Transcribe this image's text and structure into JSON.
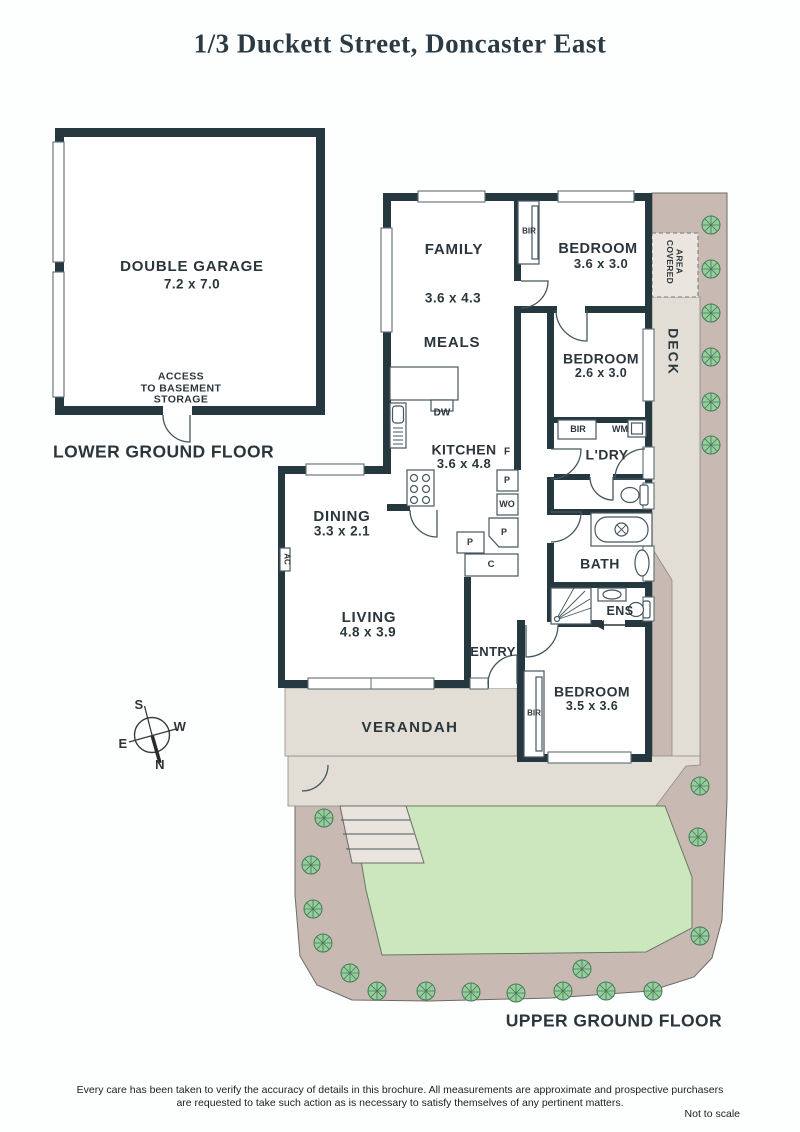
{
  "title": "1/3 Duckett Street, Doncaster East",
  "floors": {
    "lower_label": "LOWER GROUND FLOOR",
    "upper_label": "UPPER GROUND FLOOR"
  },
  "rooms": {
    "garage": {
      "name": "DOUBLE GARAGE",
      "dims": "7.2 x 7.0"
    },
    "family": {
      "name": "FAMILY",
      "dims": "3.6 x 4.3"
    },
    "meals": {
      "name": "MEALS"
    },
    "kitchen": {
      "name": "KITCHEN",
      "dims": "3.6 x 4.8"
    },
    "dining": {
      "name": "DINING",
      "dims": "3.3 x 2.1"
    },
    "living": {
      "name": "LIVING",
      "dims": "4.8 x 3.9"
    },
    "entry": {
      "name": "ENTRY"
    },
    "verandah": {
      "name": "VERANDAH"
    },
    "deck": {
      "name": "DECK"
    },
    "covered_area": {
      "line1": "COVERED",
      "line2": "AREA"
    },
    "bedroom1": {
      "name": "BEDROOM",
      "dims": "3.6 x 3.0"
    },
    "bedroom2": {
      "name": "BEDROOM",
      "dims": "2.6 x 3.0"
    },
    "bedroom3": {
      "name": "BEDROOM",
      "dims": "3.5 x 3.6"
    },
    "laundry": {
      "name": "L'DRY"
    },
    "bath": {
      "name": "BATH"
    },
    "ens": {
      "name": "ENS"
    }
  },
  "fixtures": {
    "bir": "BIR",
    "wm": "WM",
    "dw": "DW",
    "fridge": "F",
    "pantry": "P",
    "wall_oven": "WO",
    "cupboard": "C",
    "ac": "AC",
    "access": {
      "line1": "ACCESS",
      "line2": "TO BASEMENT",
      "line3": "STORAGE"
    }
  },
  "compass": {
    "n": "N",
    "s": "S",
    "e": "E",
    "w": "W"
  },
  "footer": {
    "disclaimer_line1": "Every care has been taken to verify the accuracy of details in this brochure.  All measurements are approximate and prospective purchasers",
    "disclaimer_line2": "are requested to take such action as is necessary to satisfy themselves of any pertinent matters.",
    "scale_note": "Not to scale"
  },
  "colors": {
    "wall": "#26383f",
    "text": "#2b363c",
    "title": "#2c3a44",
    "garden": "#c8bab2",
    "lawn": "#cce6bd",
    "path": "#e2ded6",
    "tree": "#97cd9b"
  }
}
